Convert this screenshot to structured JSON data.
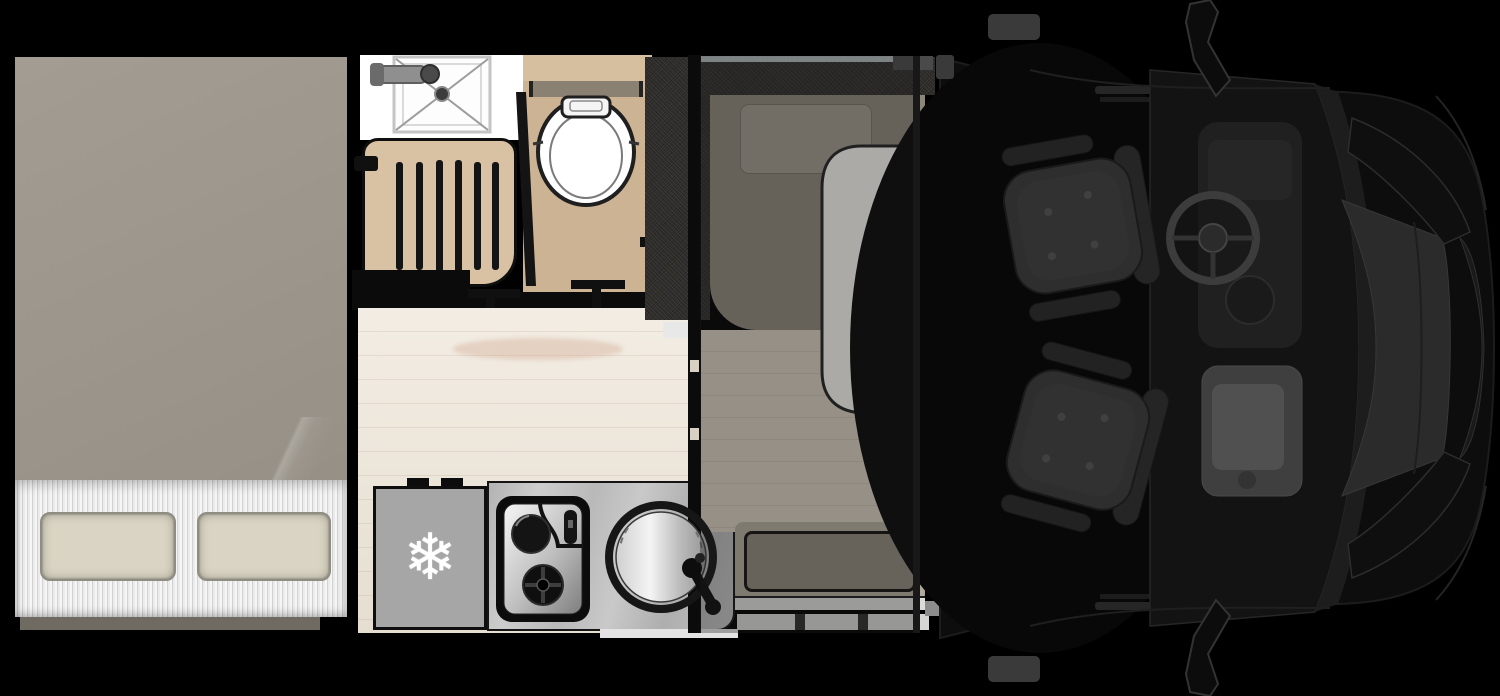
{
  "meta": {
    "title": "Motorhome floor plan",
    "view": "top-down",
    "description": "Coachbuilt motorhome layout: rear transverse bed, central bathroom with shower and toilet, mid kitchen with fridge, hob and sink, front dinette with table under drop-down bed, swivel cab seats and vehicle cab at front"
  },
  "icons": {
    "snowflake": "❄"
  },
  "palette": {
    "bg": "#000000",
    "wall": "#0b0b0b",
    "mattress": "#9a948a",
    "mattress_hi": "#a29c92",
    "mattress_lo": "#938d83",
    "sheet": "#efefed",
    "sheet_stripe": "#c9c9c7",
    "pillow": "#d9d4c3",
    "pillow_edge": "#8f8c82",
    "bath_floor": "#ccb394",
    "bath_floor_light": "#d6bf9f",
    "bath_shelf": "#8b8173",
    "bath_wood": "#d9c2a3",
    "shower_white": "#ffffff",
    "tray_line": "#9c9c9c",
    "wood_floor": "#ede5d8",
    "dinette_floor": "#d5cbbc",
    "strip_floor": "#e9e1d3",
    "counter": "#bdbdbd",
    "fridge": "#a6a6a6",
    "appliance": "#0d0d0d",
    "sofa": "#353330",
    "cushion": "#8c8678",
    "cushion_pillow": "#9e988b",
    "bench": "#8e887a",
    "bench_frame": "#b1aa9c",
    "step": "#d6d6d4",
    "table": "#f4f3ef",
    "window_slit": "#c7d0d0",
    "overlay_tint": "rgba(28,28,28,0.34)",
    "cab_body": "#0d0d0d",
    "cab_glass": "#141414",
    "hood": "#2b2b2b",
    "cab_seat": "#2e2e2e",
    "console": "#3f3f3f",
    "wheel": "#3c3c3c"
  },
  "areas": {
    "bedroom": {
      "name": "rear bedroom",
      "fixtures": [
        "double mattress",
        "two pillows",
        "bed step"
      ]
    },
    "bathroom": {
      "name": "bathroom",
      "fixtures": [
        "shower tray with mixer tap",
        "slatted cabinet",
        "toilet with cistern",
        "door"
      ]
    },
    "kitchen": {
      "name": "kitchen",
      "fixtures": [
        "fridge",
        "two-burner hob",
        "round sink with tap",
        "worktop"
      ]
    },
    "dinette": {
      "name": "dinette",
      "fixtures": [
        "L-shaped sofa",
        "seat cushion",
        "table",
        "side bench",
        "entry step",
        "drop-down bed overlay",
        "window"
      ]
    },
    "cab": {
      "name": "driver cab",
      "fixtures": [
        "two swivel captain seats",
        "steering wheel",
        "dashboard console",
        "windshield",
        "hood",
        "grille",
        "two wing mirrors"
      ]
    }
  }
}
